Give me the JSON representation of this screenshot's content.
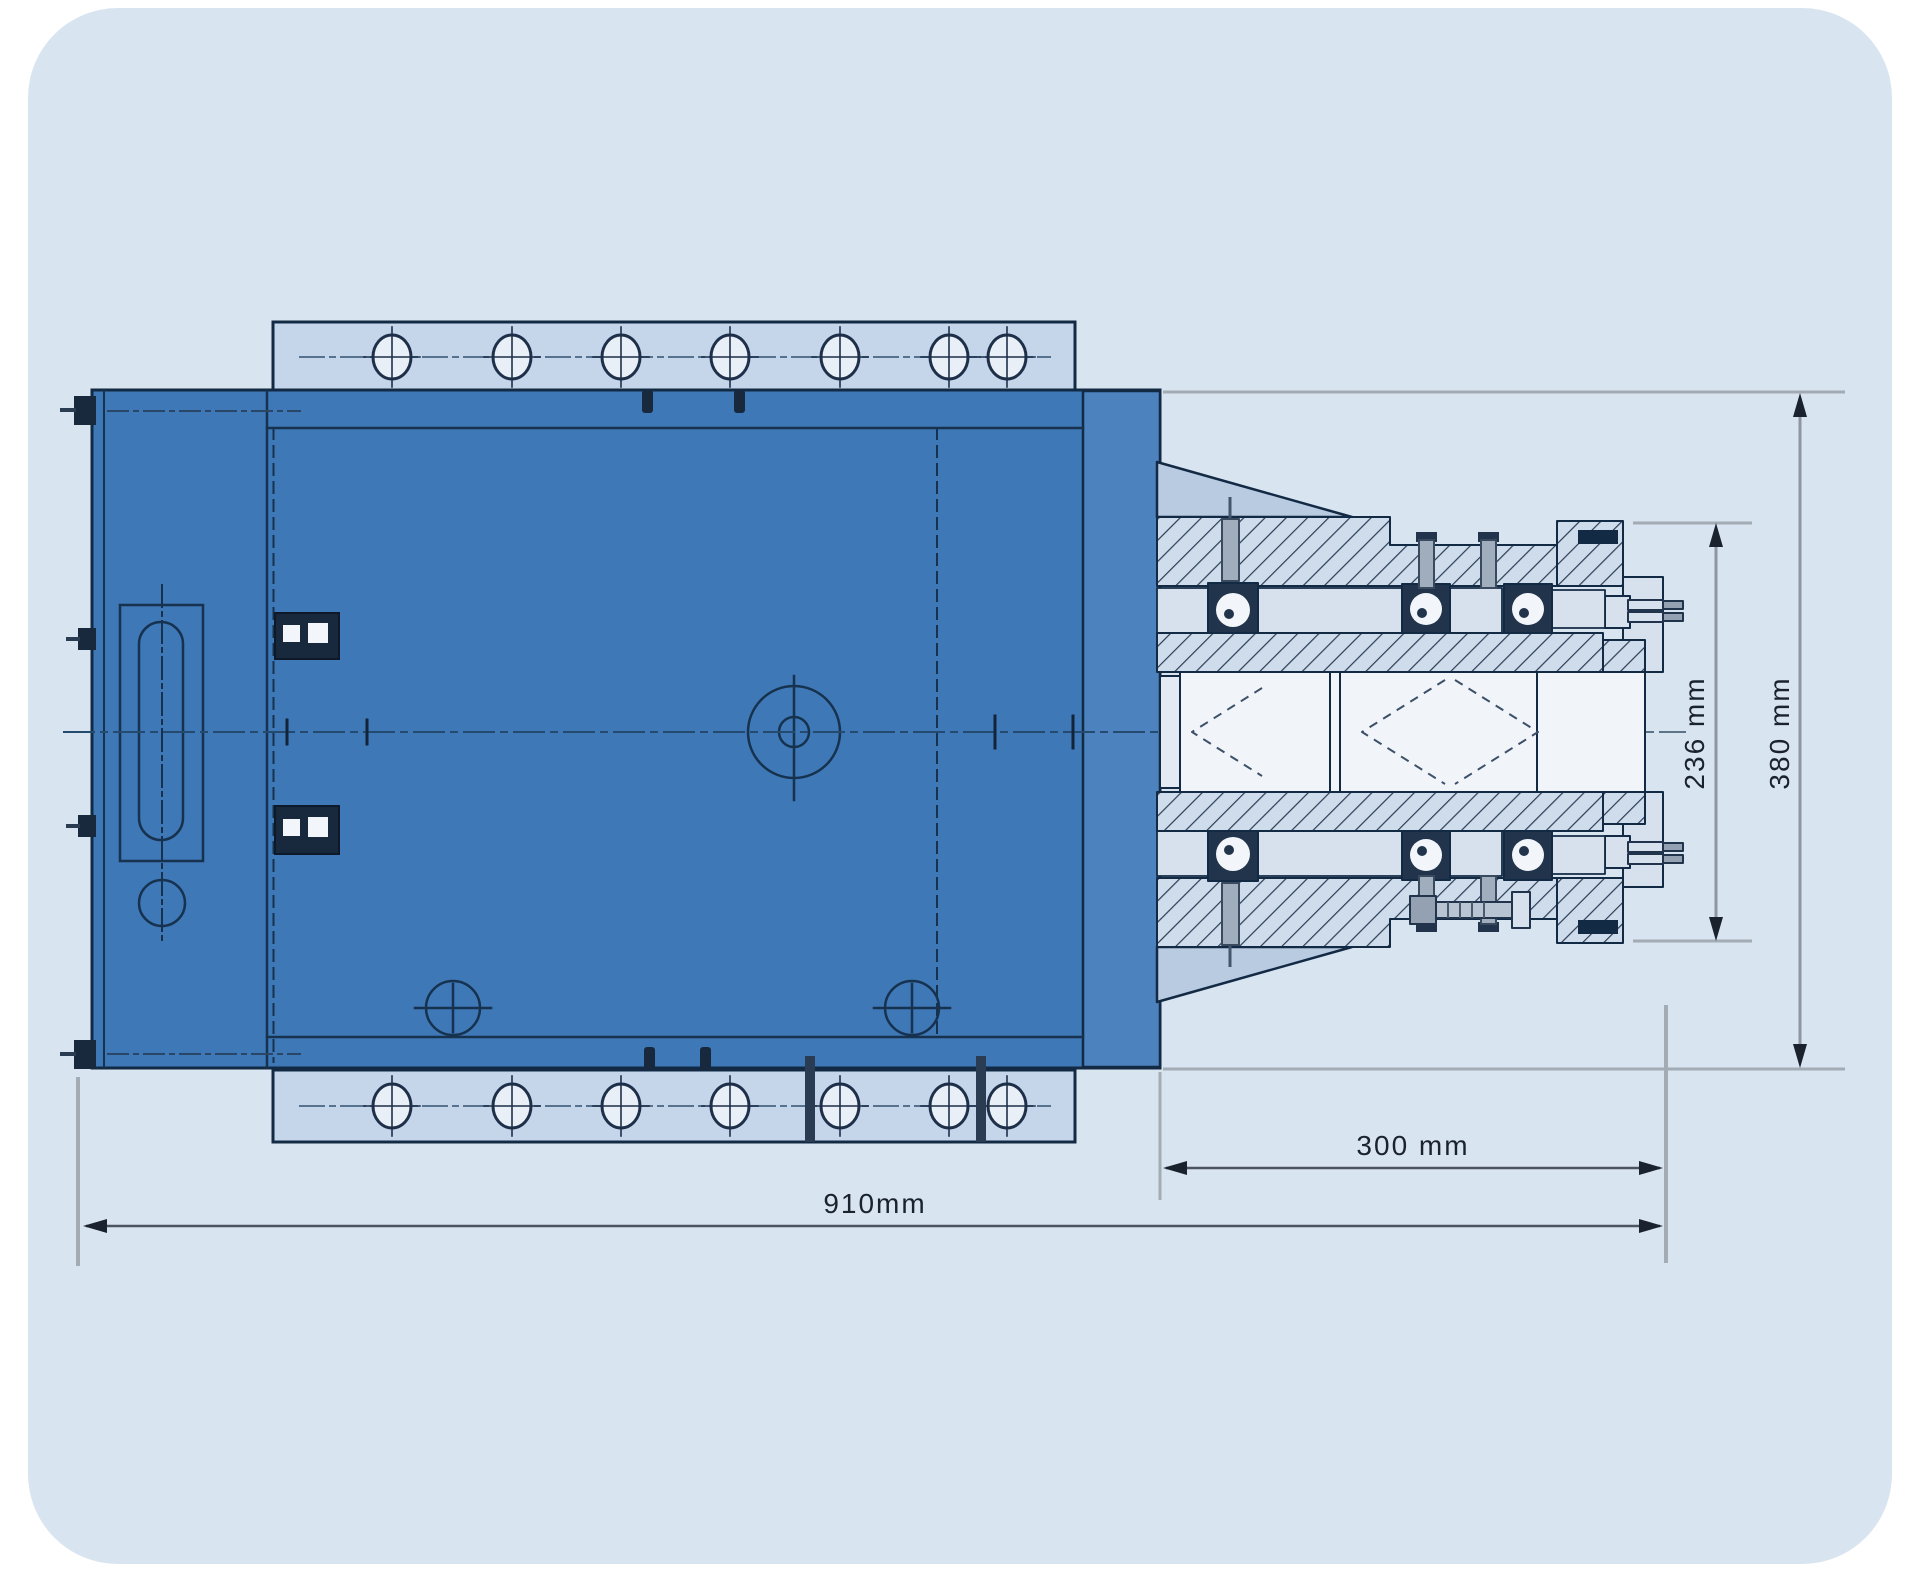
{
  "drawing": {
    "type": "technical-drawing-milling-head-spindle",
    "labels": {
      "overall_width": "910mm",
      "spindle_length": "300 mm",
      "spindle_diameter": "236 mm",
      "overall_height": "380 mm"
    },
    "colors": {
      "page_background": "#ffffff",
      "panel_background": "#d9e4f1",
      "body_blue": "#3e78b7",
      "body_blue_light": "#4c82be",
      "flange_fill": "#c5d6ea",
      "hole_fill": "#e9eff7",
      "outline_dark": "#132a44",
      "hatch_fill": "#cfdcec",
      "hatch_line": "#2a3d55",
      "section_light": "#d7e1ee",
      "bore_white": "#f1f5fa",
      "stud_gray": "#9fadbd",
      "dimension_gray": "#a3abb4",
      "dimension_line": "#4a5560",
      "dimension_text": "#1a222e",
      "centerline_blue": "#254a70"
    }
  }
}
